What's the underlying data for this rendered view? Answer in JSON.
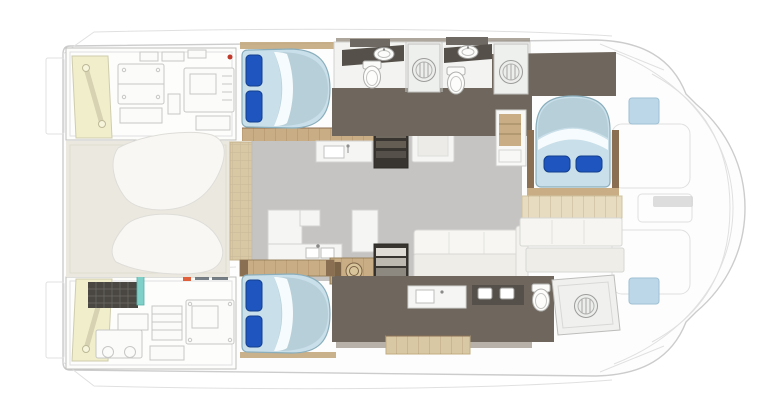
{
  "page": {
    "title": "Catamaran deck plan",
    "description": "Top-view interior layout plan of a power catamaran, bow to the right",
    "background": "#ffffff"
  },
  "colors": {
    "page_bg": "#ffffff",
    "hull_line": "#cccccc",
    "faint_line": "#e0e0e0",
    "machinery_line": "#c7c7c5",
    "floor_dark": "#6f675d",
    "floor_salon": "#c6c4c2",
    "deck_beige": "#ebe8df",
    "teak": "#d9c8a4",
    "teak_dark": "#c9ad84",
    "wood_dark": "#8a6f52",
    "counter_white": "#f5f5f3",
    "bed_mattress": "#c9dfe9",
    "bed_head": "#b7cfd9",
    "bed_sheet": "#f6fbfd",
    "bed_edge": "#8aaebc",
    "pillow": "#1e55bf",
    "pillow_edge": "#123f8e",
    "vanity_dark": "#55504a",
    "stair_dark": "#38342f",
    "wall_gray": "#989084",
    "wall_wood": "#c3a87e",
    "accent_yellow": "#f1eecb",
    "accent_teal": "#7ed0c8",
    "accent_red": "#c0392b",
    "accent_orange": "#e0603c",
    "hatch_blue": "#bcd7e8",
    "panel_dark": "#4a4742"
  },
  "plan": {
    "rooms": [
      {
        "id": "salon",
        "label": "Salon with galley, sink, stove, table and sofa"
      },
      {
        "id": "aft-cockpit",
        "label": "Aft cockpit deck with two curved loungers"
      },
      {
        "id": "port-aft-cabin",
        "label": "Aft double cabin, top hull"
      },
      {
        "id": "starboard-aft-cabin",
        "label": "Aft double cabin, bottom hull"
      },
      {
        "id": "forward-cabin",
        "label": "Forward double cabin with athwartships berth"
      },
      {
        "id": "bathrooms",
        "label": "En-suite heads with showers, toilets and vanities"
      },
      {
        "id": "engine-rooms",
        "label": "Two stern engine/machinery rooms"
      },
      {
        "id": "foredeck",
        "label": "Bow deck with seat outlines and hatches"
      }
    ],
    "fixtures": {
      "double_berths": 3,
      "pillows": 6,
      "showers": 3,
      "toilets": 3,
      "sinks": 4,
      "stair_companionways": 2,
      "engine_rooms": 2,
      "cockpit_loungers": 2,
      "deck_hatches": 2
    }
  }
}
